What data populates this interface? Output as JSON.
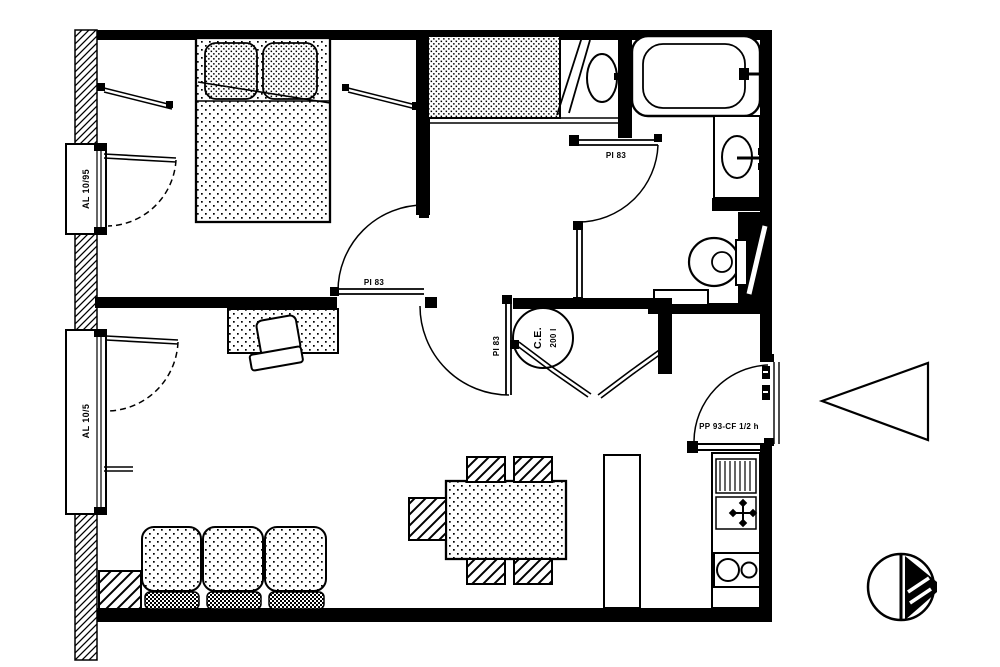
{
  "page": {
    "type": "apartment floor plan drawing",
    "paper_color": "#ffffff",
    "ink_color": "#000000"
  },
  "labels": {
    "window_upper": "AL 10/95",
    "window_lower": "AL 10/5",
    "bedroom_door": "PI 83",
    "bathroom_door": "PI 83",
    "living_door": "PI 83",
    "water_heater_abbr": "C.E.",
    "water_heater_capacity": "200 l",
    "entrance_door": "PP 93-CF 1/2 h"
  },
  "symbols": {
    "north_arrow": "north direction symbol",
    "entrance_arrow": "entrance direction arrow"
  }
}
